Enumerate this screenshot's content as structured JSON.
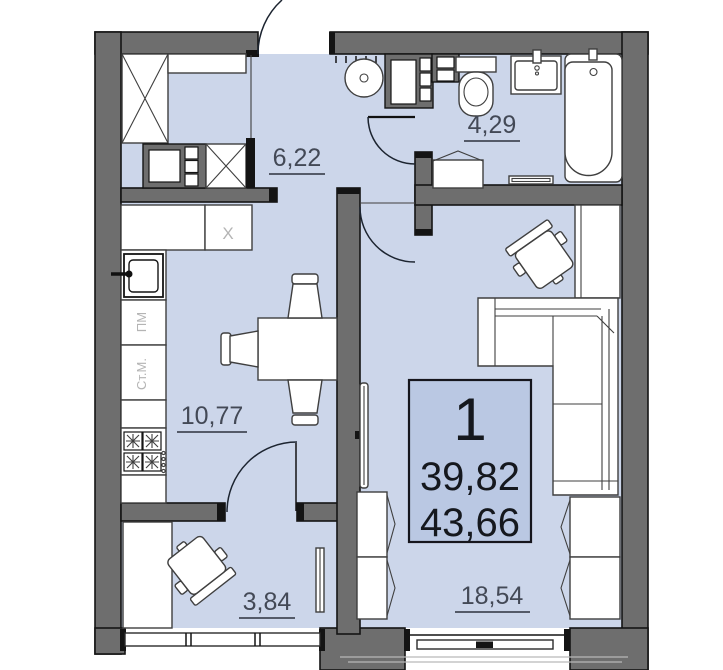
{
  "plan": {
    "info_box": {
      "number": "1",
      "living_area": "39,82",
      "total_area": "43,66"
    },
    "rooms": [
      {
        "name": "hallway",
        "area_label": "6,22"
      },
      {
        "name": "bathroom",
        "area_label": "4,29"
      },
      {
        "name": "kitchen",
        "area_label": "10,77"
      },
      {
        "name": "small-room",
        "area_label": "3,84"
      },
      {
        "name": "living-room",
        "area_label": "18,54"
      }
    ],
    "appliances": {
      "cabinet_mark": "X",
      "dishwasher": "ПМ",
      "washing_machine": "Ст.М."
    },
    "colors": {
      "floor": "#ccd6ea",
      "wall": "#6e6e6e",
      "outline": "#141414",
      "info_box_fill": "#bac8e3",
      "label": "#434956",
      "muted_label": "#b4b4b4"
    }
  }
}
